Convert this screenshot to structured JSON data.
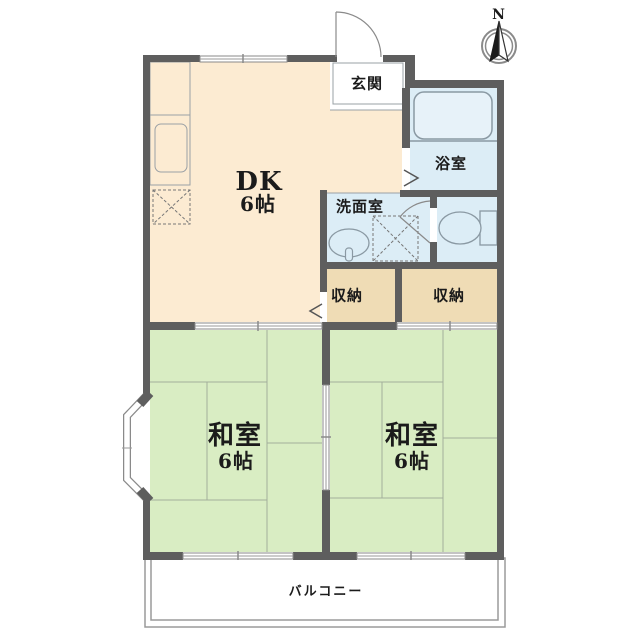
{
  "compass": {
    "north_label": "N"
  },
  "rooms": {
    "dk": {
      "label": "DK",
      "size": "6帖"
    },
    "entrance": {
      "label": "玄関"
    },
    "bathroom": {
      "label": "浴室"
    },
    "washroom": {
      "label": "洗面室"
    },
    "storage_left": {
      "label": "収納"
    },
    "storage_right": {
      "label": "収納"
    },
    "japanese_room_left": {
      "label": "和室",
      "size": "6帖"
    },
    "japanese_room_right": {
      "label": "和室",
      "size": "6帖"
    },
    "balcony": {
      "label": "バルコニー"
    }
  },
  "colors": {
    "dk_floor": "#FCEBD2",
    "tatami_floor": "#D9EDC3",
    "wet_area_floor": "#DCEDF6",
    "storage_floor": "#EFDCB5",
    "wall": "#5E5E5E"
  },
  "fixture_icons": [
    "bathtub",
    "toilet",
    "wash-basin",
    "kitchen-counter",
    "kitchen-sink",
    "refrigerator-space",
    "washing-machine-space",
    "entrance-door",
    "bay-window",
    "compass-north-arrow"
  ]
}
